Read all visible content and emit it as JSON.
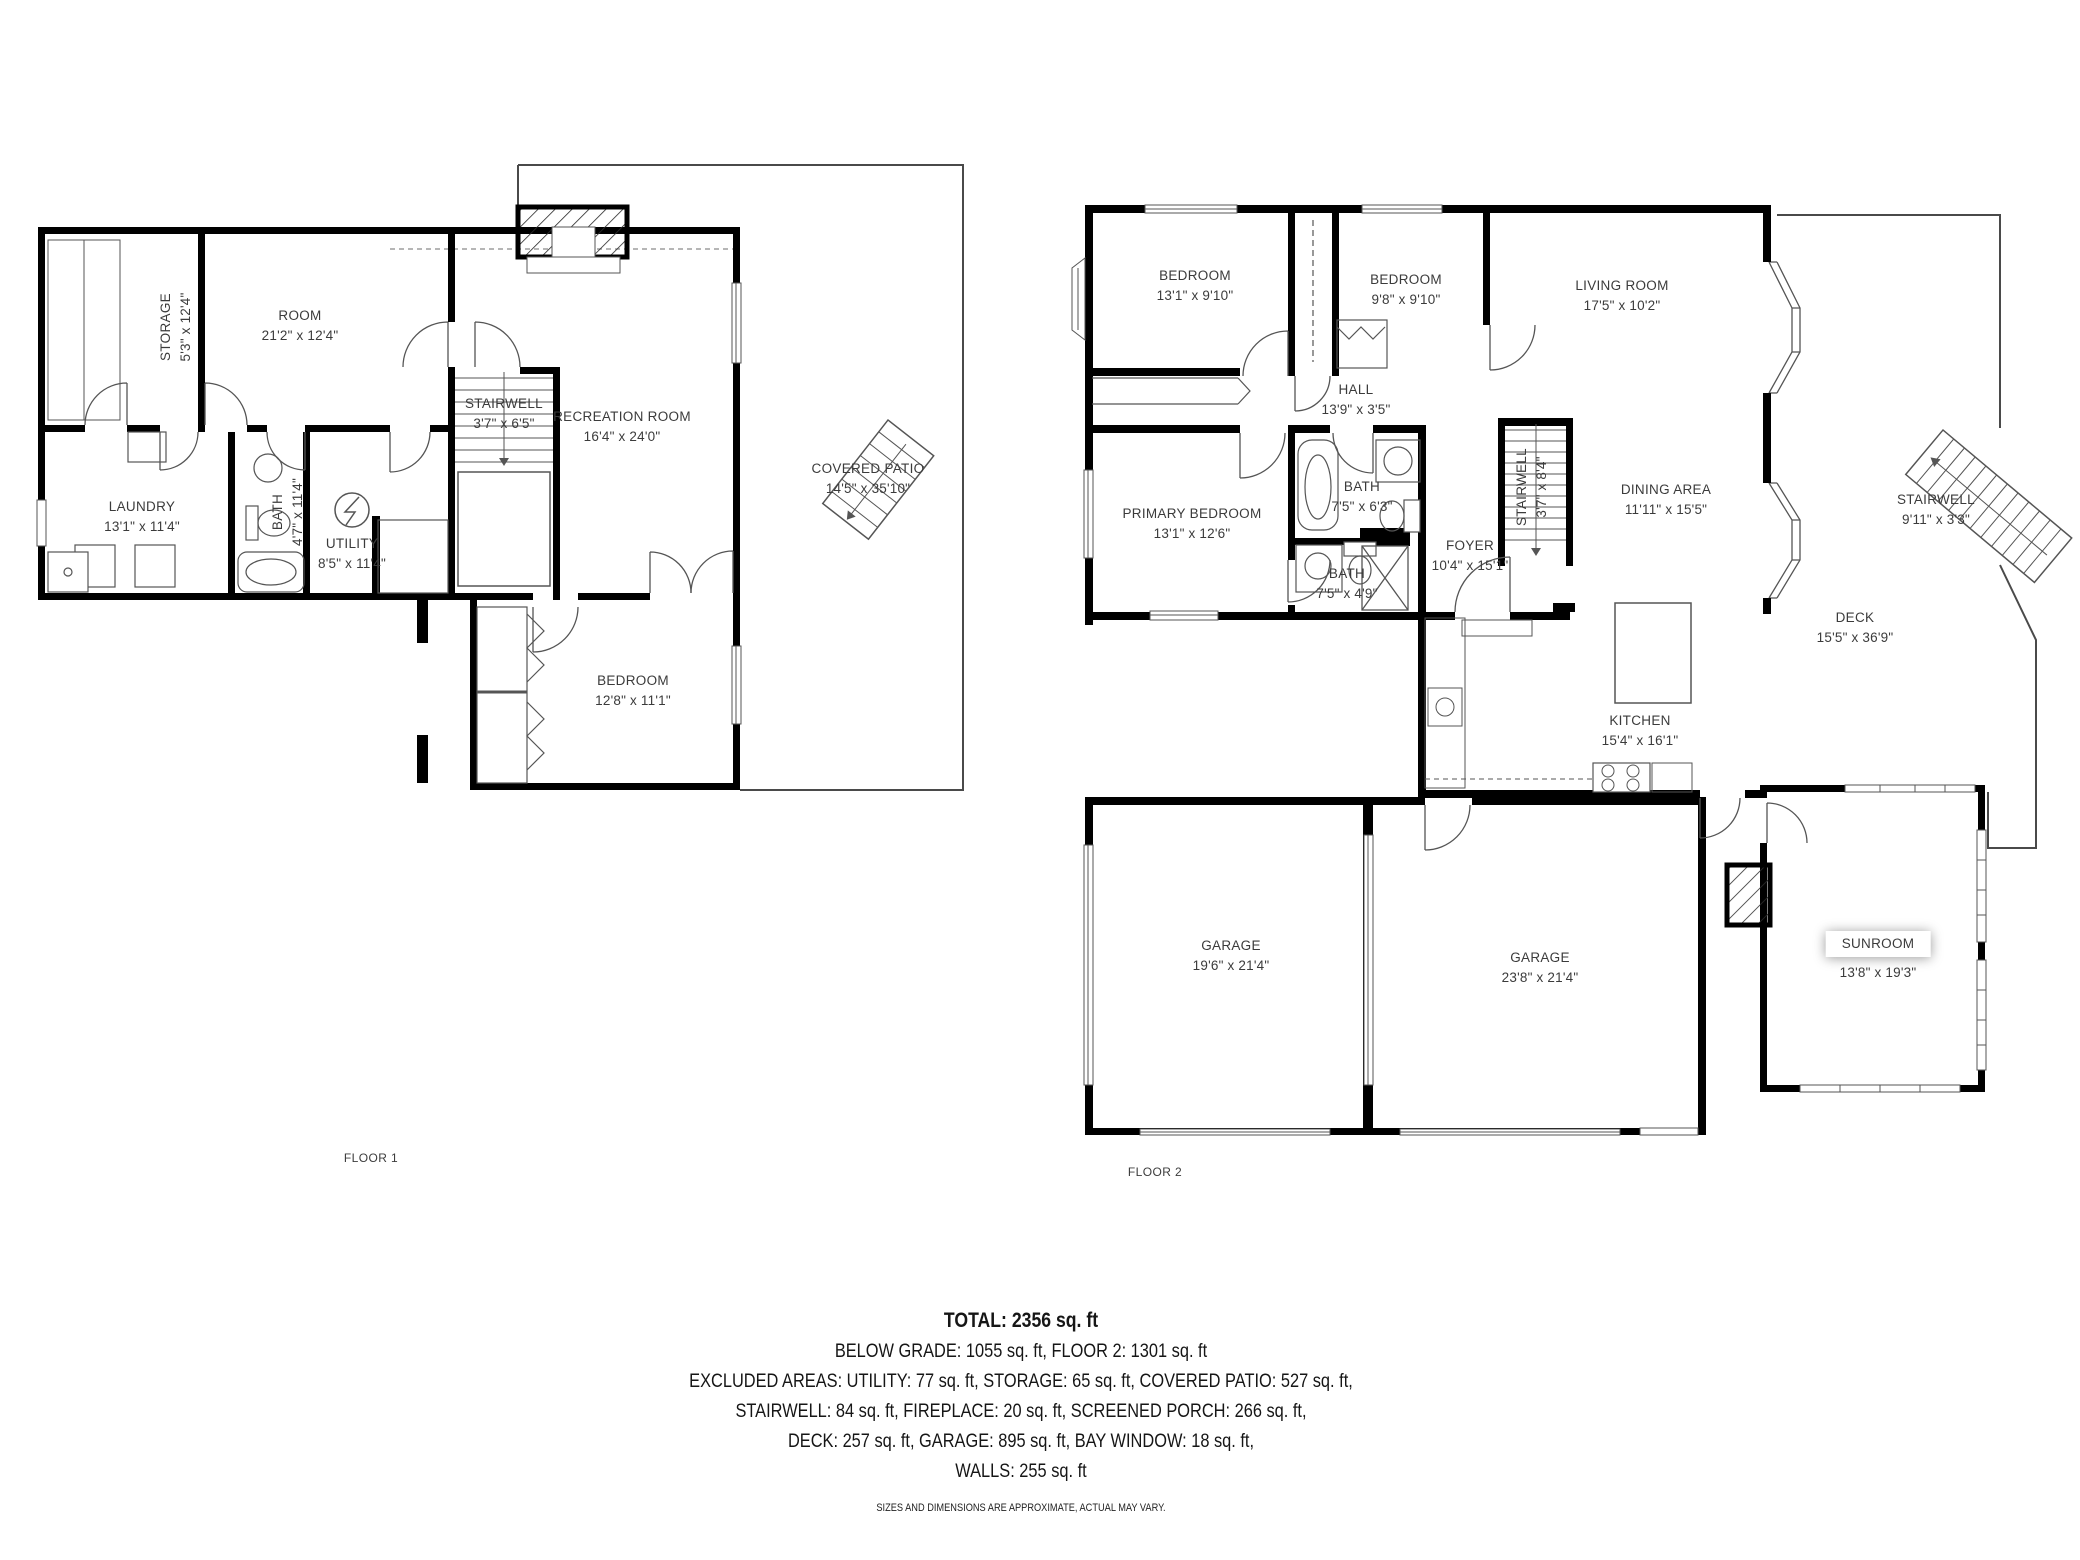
{
  "floor1": {
    "label": "FLOOR 1",
    "rooms": {
      "storage": {
        "name": "STORAGE",
        "dims": "5'3\" x 12'4\""
      },
      "room": {
        "name": "ROOM",
        "dims": "21'2\" x 12'4\""
      },
      "stairwell": {
        "name": "STAIRWELL",
        "dims": "3'7\" x 6'5\""
      },
      "recreation": {
        "name": "RECREATION ROOM",
        "dims": "16'4\" x 24'0\""
      },
      "covered_patio": {
        "name": "COVERED PATIO",
        "dims": "14'5\" x 35'10\""
      },
      "laundry": {
        "name": "LAUNDRY",
        "dims": "13'1\" x 11'4\""
      },
      "bath": {
        "name": "BATH",
        "dims": "4'7\" x 11'4\""
      },
      "utility": {
        "name": "UTILITY",
        "dims": "8'5\" x 11'4\""
      },
      "bedroom": {
        "name": "BEDROOM",
        "dims": "12'8\" x 11'1\""
      }
    }
  },
  "floor2": {
    "label": "FLOOR 2",
    "rooms": {
      "bedroom_left": {
        "name": "BEDROOM",
        "dims": "13'1\" x 9'10\""
      },
      "bedroom_right": {
        "name": "BEDROOM",
        "dims": "9'8\" x 9'10\""
      },
      "living_room": {
        "name": "LIVING ROOM",
        "dims": "17'5\" x 10'2\""
      },
      "hall": {
        "name": "HALL",
        "dims": "13'9\" x 3'5\""
      },
      "primary_bedroom": {
        "name": "PRIMARY BEDROOM",
        "dims": "13'1\" x 12'6\""
      },
      "bath_upper": {
        "name": "BATH",
        "dims": "7'5\" x 6'3\""
      },
      "bath_lower": {
        "name": "BATH",
        "dims": "7'5\" x 4'9\""
      },
      "foyer": {
        "name": "FOYER",
        "dims": "10'4\" x 15'1\""
      },
      "stairwell_inner": {
        "name": "STAIRWELL",
        "dims": "3'7\" x 8'4\""
      },
      "dining_area": {
        "name": "DINING AREA",
        "dims": "11'11\" x 15'5\""
      },
      "stairwell_deck": {
        "name": "STAIRWELL",
        "dims": "9'11\" x 3'3\""
      },
      "deck": {
        "name": "DECK",
        "dims": "15'5\" x 36'9\""
      },
      "kitchen": {
        "name": "KITCHEN",
        "dims": "15'4\" x 16'1\""
      },
      "garage_left": {
        "name": "GARAGE",
        "dims": "19'6\" x 21'4\""
      },
      "garage_right": {
        "name": "GARAGE",
        "dims": "23'8\" x 21'4\""
      },
      "sunroom": {
        "name": "SUNROOM",
        "dims": "13'8\" x 19'3\""
      }
    }
  },
  "summary": {
    "total": "TOTAL: 2356 sq. ft",
    "line2": "BELOW GRADE: 1055 sq. ft, FLOOR 2: 1301 sq. ft",
    "line3": "EXCLUDED AREAS: UTILITY: 77 sq. ft, STORAGE: 65 sq. ft, COVERED PATIO: 527 sq. ft,",
    "line4": "STAIRWELL: 84 sq. ft, FIREPLACE: 20 sq. ft, SCREENED PORCH: 266 sq. ft,",
    "line5": "DECK: 257 sq. ft, GARAGE: 895 sq. ft, BAY WINDOW: 18 sq. ft,",
    "line6": "WALLS: 255 sq. ft",
    "disclaimer": "SIZES AND DIMENSIONS ARE APPROXIMATE, ACTUAL MAY VARY."
  },
  "colors": {
    "wall": "#000000",
    "thin_line": "#4a4a4a",
    "text": "#3b3b3b"
  }
}
